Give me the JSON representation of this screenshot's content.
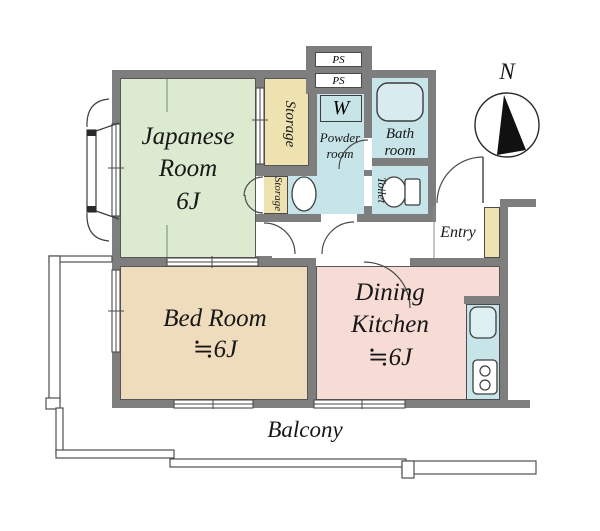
{
  "title": "Apartment floor plan",
  "compass": {
    "north_label": "N"
  },
  "rooms": {
    "japanese_room": {
      "name_line1": "Japanese",
      "name_line2": "Room",
      "size": "6J",
      "color": "#dcead0"
    },
    "bed_room": {
      "name": "Bed Room",
      "size": "≒6J",
      "color": "#efdcbd"
    },
    "dining_kitchen": {
      "name_line1": "Dining",
      "name_line2": "Kitchen",
      "size": "≒6J",
      "color": "#f7dbd5"
    },
    "balcony": {
      "name": "Balcony"
    },
    "entry": {
      "name": "Entry"
    },
    "bath_room": {
      "name_line1": "Bath",
      "name_line2": "room",
      "color": "#c7e4e8"
    },
    "powder_room": {
      "name_line1": "Powder",
      "name_line2": "room",
      "color": "#c7e4e8"
    },
    "toilet": {
      "name": "Toilet",
      "color": "#c7e4e8"
    },
    "storage_large": {
      "name": "Storage",
      "color": "#eee2b0"
    },
    "storage_small": {
      "name": "Storage",
      "color": "#eee2b0"
    },
    "washer_box": {
      "label": "W"
    },
    "ps_upper": {
      "label": "PS"
    },
    "ps_lower": {
      "label": "PS"
    }
  },
  "colors": {
    "wall": "#7e7e7e",
    "line": "#4a4a4a",
    "fixture_fill": "#ffffff",
    "tub_fill": "#d8ecef"
  }
}
